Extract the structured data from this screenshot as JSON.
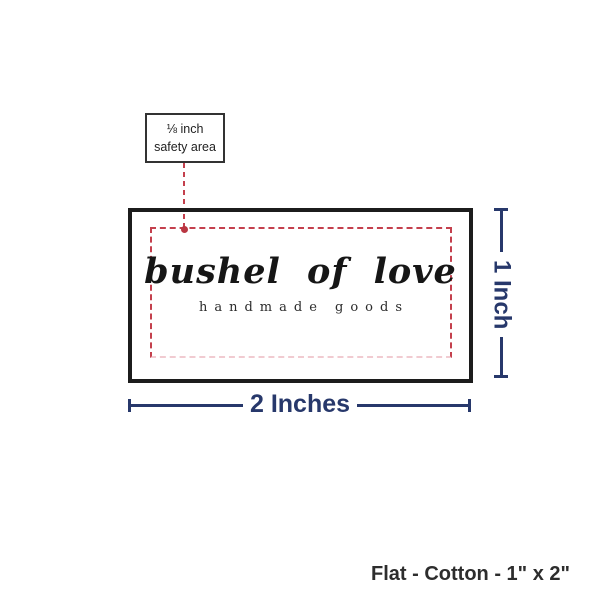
{
  "diagram": {
    "callout": {
      "line1": "⅛ inch",
      "line2": "safety area"
    },
    "label_preview": {
      "brand_name": "bushel of love",
      "tagline": "handmade goods"
    },
    "dimensions": {
      "width": "2 Inches",
      "height": "1 Inch"
    },
    "footer": {
      "spec": "Flat - Cotton - 1\" x 2\""
    },
    "colors": {
      "navy": "#27386b",
      "red": "#c4404d",
      "dot_red": "#b93541",
      "pink": "#f1cbd1",
      "border_black": "#1c1c1c"
    }
  }
}
